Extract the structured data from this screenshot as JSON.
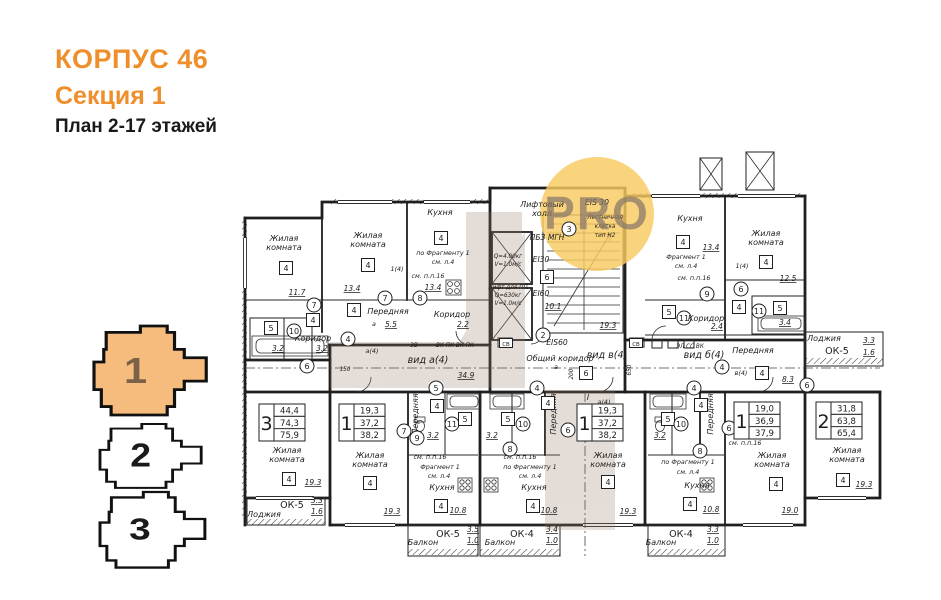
{
  "header": {
    "building": "КОРПУС 46",
    "section": "Секция 1",
    "plan": "План 2-17 этажей"
  },
  "colors": {
    "accent": "#EF8F2C",
    "section_fill": "#F6BC7D",
    "section_number_active": "#7a6148",
    "ink": "#1a1a1a",
    "watermark_yellow": "#F9CB5F",
    "watermark_text": "#8a7a6a",
    "watermark_tan": "#9a7b66"
  },
  "section_nav": {
    "items": [
      {
        "label": "1",
        "active": true
      },
      {
        "label": "2",
        "active": false
      },
      {
        "label": "3",
        "active": false
      }
    ]
  },
  "watermark": {
    "text": "PRO"
  },
  "apartment_stamps": [
    {
      "rooms": "3",
      "area_living": "44,4",
      "area_total": "74,3",
      "area_full": "75,9",
      "x": 259,
      "y": 404
    },
    {
      "rooms": "1",
      "area_living": "19,3",
      "area_total": "37,2",
      "area_full": "38,2",
      "x": 339,
      "y": 404
    },
    {
      "rooms": "1",
      "area_living": "19,3",
      "area_total": "37,2",
      "area_full": "38,2",
      "x": 577,
      "y": 404
    },
    {
      "rooms": "1",
      "area_living": "19,0",
      "area_total": "36,9",
      "area_full": "37,9",
      "x": 734,
      "y": 402
    },
    {
      "rooms": "2",
      "area_living": "31,8",
      "area_total": "63,8",
      "area_full": "65,4",
      "x": 816,
      "y": 402
    }
  ],
  "plan_labels": [
    {
      "t": "Жилая\nкомната",
      "x": 284,
      "y": 241,
      "k": "room"
    },
    {
      "t": "4",
      "x": 286,
      "y": 268,
      "k": "box"
    },
    {
      "t": "11.7",
      "x": 297,
      "y": 295,
      "k": "dim"
    },
    {
      "t": "7",
      "x": 314,
      "y": 305,
      "k": "circ"
    },
    {
      "t": "Жилая\nкомната",
      "x": 368,
      "y": 238,
      "k": "room"
    },
    {
      "t": "4",
      "x": 368,
      "y": 265,
      "k": "box"
    },
    {
      "t": "13.4",
      "x": 352,
      "y": 291,
      "k": "dim"
    },
    {
      "t": "7",
      "x": 385,
      "y": 298,
      "k": "circ"
    },
    {
      "t": "1(4)",
      "x": 397,
      "y": 271,
      "k": "small"
    },
    {
      "t": "Кухня",
      "x": 440,
      "y": 215,
      "k": "room"
    },
    {
      "t": "4",
      "x": 441,
      "y": 238,
      "k": "box"
    },
    {
      "t": "по Фрагменту 1",
      "x": 443,
      "y": 255,
      "k": "small"
    },
    {
      "t": "см. л.4",
      "x": 443,
      "y": 264,
      "k": "small"
    },
    {
      "t": "см. п.п.16",
      "x": 428,
      "y": 278,
      "k": "small"
    },
    {
      "t": "13.4",
      "x": 433,
      "y": 290,
      "k": "dim"
    },
    {
      "t": "8",
      "x": 420,
      "y": 298,
      "k": "circ"
    },
    {
      "t": "Передняя",
      "x": 388,
      "y": 314,
      "k": "room"
    },
    {
      "t": "4",
      "x": 354,
      "y": 310,
      "k": "box"
    },
    {
      "t": "а",
      "x": 374,
      "y": 326,
      "k": "small"
    },
    {
      "t": "5.5",
      "x": 391,
      "y": 327,
      "k": "dim"
    },
    {
      "t": "4",
      "x": 348,
      "y": 339,
      "k": "circ"
    },
    {
      "t": "а(4)",
      "x": 372,
      "y": 353,
      "k": "small"
    },
    {
      "t": "Коридор",
      "x": 452,
      "y": 317,
      "k": "room"
    },
    {
      "t": "2.2",
      "x": 463,
      "y": 327,
      "k": "dim"
    },
    {
      "t": "Коридор",
      "x": 313,
      "y": 341,
      "k": "room"
    },
    {
      "t": "3.2",
      "x": 322,
      "y": 351,
      "k": "dim"
    },
    {
      "t": "4",
      "x": 313,
      "y": 320,
      "k": "box"
    },
    {
      "t": "10",
      "x": 294,
      "y": 331,
      "k": "circ"
    },
    {
      "t": "5",
      "x": 271,
      "y": 328,
      "k": "box"
    },
    {
      "t": "3.2",
      "x": 278,
      "y": 351,
      "k": "dim"
    },
    {
      "t": "6",
      "x": 307,
      "y": 366,
      "k": "circ"
    },
    {
      "t": "150",
      "x": 345,
      "y": 371,
      "k": "tiny"
    },
    {
      "t": "Лифтовый\nхолл",
      "x": 542,
      "y": 207,
      "k": "room"
    },
    {
      "t": "3",
      "x": 569,
      "y": 229,
      "k": "circ"
    },
    {
      "t": "EIS 30",
      "x": 597,
      "y": 205,
      "k": "tech"
    },
    {
      "t": "Лестничная\nклетка\nтип Н2",
      "x": 605,
      "y": 219,
      "k": "tiny"
    },
    {
      "t": "ПБЗ МГН",
      "x": 547,
      "y": 240,
      "k": "tech"
    },
    {
      "t": "Q=4.00кг",
      "x": 508,
      "y": 258,
      "k": "tiny"
    },
    {
      "t": "V=1.0м/с",
      "x": 508,
      "y": 266,
      "k": "tiny"
    },
    {
      "t": "EI30",
      "x": 541,
      "y": 262,
      "k": "tech"
    },
    {
      "t": "6",
      "x": 547,
      "y": 277,
      "k": "box"
    },
    {
      "t": "Лифт для ПП",
      "x": 508,
      "y": 289,
      "k": "tiny"
    },
    {
      "t": "Q=630кг",
      "x": 508,
      "y": 297,
      "k": "tiny"
    },
    {
      "t": "V=1.0м/с",
      "x": 508,
      "y": 305,
      "k": "tiny"
    },
    {
      "t": "EI60",
      "x": 541,
      "y": 296,
      "k": "tech"
    },
    {
      "t": "10.1",
      "x": 553,
      "y": 309,
      "k": "dim"
    },
    {
      "t": "19.3",
      "x": 608,
      "y": 328,
      "k": "dim"
    },
    {
      "t": "2",
      "x": 543,
      "y": 335,
      "k": "circ"
    },
    {
      "t": "EIS60",
      "x": 557,
      "y": 345,
      "k": "tech"
    },
    {
      "t": "Общий коридор",
      "x": 560,
      "y": 361,
      "k": "room"
    },
    {
      "t": "вид а(4)",
      "x": 428,
      "y": 363,
      "k": "view"
    },
    {
      "t": "34.9",
      "x": 466,
      "y": 378,
      "k": "dim"
    },
    {
      "t": "вид в(4)",
      "x": 607,
      "y": 358,
      "k": "view"
    },
    {
      "t": "вид б(4)",
      "x": 704,
      "y": 358,
      "k": "view"
    },
    {
      "t": "6",
      "x": 586,
      "y": 373,
      "k": "box"
    },
    {
      "t": "а",
      "x": 556,
      "y": 369,
      "k": "small"
    },
    {
      "t": "650",
      "x": 631,
      "y": 370,
      "k": "tiny",
      "v": true
    },
    {
      "t": "200",
      "x": 573,
      "y": 374,
      "k": "tiny",
      "v": true
    },
    {
      "t": "3В",
      "x": 414,
      "y": 347,
      "k": "tiny"
    },
    {
      "t": "ВК ПК ВК ПК",
      "x": 455,
      "y": 347,
      "k": "tiny"
    },
    {
      "t": "СВ",
      "x": 506,
      "y": 343,
      "k": "sbox"
    },
    {
      "t": "СВ",
      "x": 636,
      "y": 343,
      "k": "sbox"
    },
    {
      "t": "ЭЛ СС ВК",
      "x": 690,
      "y": 348,
      "k": "tiny"
    },
    {
      "t": "Кухня",
      "x": 690,
      "y": 221,
      "k": "room"
    },
    {
      "t": "4",
      "x": 683,
      "y": 242,
      "k": "box"
    },
    {
      "t": "13.4",
      "x": 711,
      "y": 250,
      "k": "dim"
    },
    {
      "t": "Фрагмент 1",
      "x": 686,
      "y": 259,
      "k": "small"
    },
    {
      "t": "см. л.4",
      "x": 686,
      "y": 268,
      "k": "small"
    },
    {
      "t": "см. п.п.16",
      "x": 694,
      "y": 280,
      "k": "small"
    },
    {
      "t": "9",
      "x": 707,
      "y": 294,
      "k": "circ"
    },
    {
      "t": "5",
      "x": 669,
      "y": 312,
      "k": "box"
    },
    {
      "t": "11",
      "x": 684,
      "y": 318,
      "k": "circ"
    },
    {
      "t": "Коридор",
      "x": 706,
      "y": 321,
      "k": "room"
    },
    {
      "t": "2.4",
      "x": 717,
      "y": 329,
      "k": "dim"
    },
    {
      "t": "1(4)",
      "x": 742,
      "y": 268,
      "k": "small"
    },
    {
      "t": "6",
      "x": 741,
      "y": 289,
      "k": "circ"
    },
    {
      "t": "4",
      "x": 739,
      "y": 307,
      "k": "box"
    },
    {
      "t": "Жилая\nкомната",
      "x": 766,
      "y": 236,
      "k": "room"
    },
    {
      "t": "4",
      "x": 766,
      "y": 262,
      "k": "box"
    },
    {
      "t": "12.5",
      "x": 788,
      "y": 281,
      "k": "dim"
    },
    {
      "t": "11",
      "x": 759,
      "y": 311,
      "k": "circ"
    },
    {
      "t": "5",
      "x": 780,
      "y": 308,
      "k": "box"
    },
    {
      "t": "3.4",
      "x": 785,
      "y": 325,
      "k": "dim"
    },
    {
      "t": "Передняя",
      "x": 753,
      "y": 353,
      "k": "room"
    },
    {
      "t": "4",
      "x": 762,
      "y": 373,
      "k": "box"
    },
    {
      "t": "в(4)",
      "x": 741,
      "y": 375,
      "k": "small"
    },
    {
      "t": "4",
      "x": 722,
      "y": 367,
      "k": "circ"
    },
    {
      "t": "8.3",
      "x": 788,
      "y": 382,
      "k": "dim"
    },
    {
      "t": "6",
      "x": 807,
      "y": 385,
      "k": "circ"
    },
    {
      "t": "Лоджия",
      "x": 824,
      "y": 341,
      "k": "room"
    },
    {
      "t": "ОК-5",
      "x": 837,
      "y": 354,
      "k": "ok"
    },
    {
      "t": "3.3",
      "x": 869,
      "y": 343,
      "k": "dim"
    },
    {
      "t": "1.6",
      "x": 869,
      "y": 355,
      "k": "dim"
    },
    {
      "t": "Жилая\nкомната",
      "x": 287,
      "y": 453,
      "k": "room"
    },
    {
      "t": "4",
      "x": 289,
      "y": 479,
      "k": "box"
    },
    {
      "t": "19.3",
      "x": 313,
      "y": 485,
      "k": "dim"
    },
    {
      "t": "Лоджия",
      "x": 264,
      "y": 517,
      "k": "room"
    },
    {
      "t": "ОК-5",
      "x": 292,
      "y": 508,
      "k": "ok"
    },
    {
      "t": "3.3",
      "x": 317,
      "y": 503,
      "k": "dim"
    },
    {
      "t": "1.6",
      "x": 317,
      "y": 514,
      "k": "dim"
    },
    {
      "t": "5",
      "x": 436,
      "y": 388,
      "k": "circ"
    },
    {
      "t": "Жилая\nкомната",
      "x": 370,
      "y": 458,
      "k": "room"
    },
    {
      "t": "4",
      "x": 370,
      "y": 483,
      "k": "box"
    },
    {
      "t": "19.3",
      "x": 392,
      "y": 514,
      "k": "dim"
    },
    {
      "t": "Передняя",
      "x": 418,
      "y": 414,
      "k": "room",
      "v": true
    },
    {
      "t": "4",
      "x": 437,
      "y": 406,
      "k": "box"
    },
    {
      "t": "11",
      "x": 452,
      "y": 424,
      "k": "circ"
    },
    {
      "t": "5",
      "x": 465,
      "y": 419,
      "k": "box"
    },
    {
      "t": "7",
      "x": 404,
      "y": 431,
      "k": "circ"
    },
    {
      "t": "9",
      "x": 417,
      "y": 438,
      "k": "circ"
    },
    {
      "t": "3.2",
      "x": 433,
      "y": 438,
      "k": "dim"
    },
    {
      "t": "см. п.п.16",
      "x": 430,
      "y": 459,
      "k": "small"
    },
    {
      "t": "Фрагмент 1",
      "x": 440,
      "y": 469,
      "k": "small"
    },
    {
      "t": "см. л.4",
      "x": 439,
      "y": 478,
      "k": "small"
    },
    {
      "t": "Кухня",
      "x": 442,
      "y": 490,
      "k": "room"
    },
    {
      "t": "4",
      "x": 441,
      "y": 506,
      "k": "box"
    },
    {
      "t": "10.8",
      "x": 458,
      "y": 513,
      "k": "dim"
    },
    {
      "t": "ОК-5",
      "x": 448,
      "y": 537,
      "k": "ok"
    },
    {
      "t": "3.5",
      "x": 473,
      "y": 532,
      "k": "dim"
    },
    {
      "t": "1.0",
      "x": 473,
      "y": 543,
      "k": "dim"
    },
    {
      "t": "Балкон",
      "x": 423,
      "y": 545,
      "k": "room"
    },
    {
      "t": "4",
      "x": 537,
      "y": 388,
      "k": "circ"
    },
    {
      "t": "5",
      "x": 508,
      "y": 419,
      "k": "box"
    },
    {
      "t": "10",
      "x": 523,
      "y": 424,
      "k": "circ"
    },
    {
      "t": "3.2",
      "x": 492,
      "y": 438,
      "k": "dim"
    },
    {
      "t": "8",
      "x": 510,
      "y": 449,
      "k": "circ"
    },
    {
      "t": "см. п.п.16",
      "x": 520,
      "y": 459,
      "k": "small"
    },
    {
      "t": "по Фрагменту 1",
      "x": 530,
      "y": 469,
      "k": "small"
    },
    {
      "t": "см. л.4",
      "x": 530,
      "y": 478,
      "k": "small"
    },
    {
      "t": "Кухня",
      "x": 534,
      "y": 490,
      "k": "room"
    },
    {
      "t": "4",
      "x": 533,
      "y": 506,
      "k": "box"
    },
    {
      "t": "10.8",
      "x": 549,
      "y": 513,
      "k": "dim"
    },
    {
      "t": "ОК-4",
      "x": 522,
      "y": 537,
      "k": "ok"
    },
    {
      "t": "3.4",
      "x": 552,
      "y": 532,
      "k": "dim"
    },
    {
      "t": "1.0",
      "x": 552,
      "y": 543,
      "k": "dim"
    },
    {
      "t": "Балкон",
      "x": 500,
      "y": 545,
      "k": "room"
    },
    {
      "t": "Передняя",
      "x": 556,
      "y": 414,
      "k": "room",
      "v": true
    },
    {
      "t": "4",
      "x": 548,
      "y": 403,
      "k": "box"
    },
    {
      "t": "6",
      "x": 568,
      "y": 430,
      "k": "circ"
    },
    {
      "t": "I",
      "x": 588,
      "y": 400,
      "k": "tech"
    },
    {
      "t": "а(4)",
      "x": 604,
      "y": 404,
      "k": "small"
    },
    {
      "t": "Жилая\nкомната",
      "x": 608,
      "y": 458,
      "k": "room"
    },
    {
      "t": "4",
      "x": 608,
      "y": 482,
      "k": "box"
    },
    {
      "t": "19.3",
      "x": 628,
      "y": 514,
      "k": "dim"
    },
    {
      "t": "4",
      "x": 694,
      "y": 388,
      "k": "circ"
    },
    {
      "t": "5",
      "x": 668,
      "y": 419,
      "k": "box"
    },
    {
      "t": "10",
      "x": 681,
      "y": 424,
      "k": "circ"
    },
    {
      "t": "3.2",
      "x": 660,
      "y": 438,
      "k": "dim"
    },
    {
      "t": "Передняя",
      "x": 713,
      "y": 414,
      "k": "room",
      "v": true
    },
    {
      "t": "4",
      "x": 701,
      "y": 405,
      "k": "box"
    },
    {
      "t": "8",
      "x": 700,
      "y": 451,
      "k": "circ"
    },
    {
      "t": "по Фрагменту 1",
      "x": 688,
      "y": 464,
      "k": "small"
    },
    {
      "t": "см. л.4",
      "x": 688,
      "y": 474,
      "k": "small"
    },
    {
      "t": "Кухня",
      "x": 697,
      "y": 488,
      "k": "room"
    },
    {
      "t": "4",
      "x": 690,
      "y": 504,
      "k": "box"
    },
    {
      "t": "10.8",
      "x": 711,
      "y": 512,
      "k": "dim"
    },
    {
      "t": "ОК-4",
      "x": 681,
      "y": 537,
      "k": "ok"
    },
    {
      "t": "3.3",
      "x": 713,
      "y": 532,
      "k": "dim"
    },
    {
      "t": "1.0",
      "x": 713,
      "y": 543,
      "k": "dim"
    },
    {
      "t": "Балкон",
      "x": 661,
      "y": 545,
      "k": "room"
    },
    {
      "t": "6",
      "x": 729,
      "y": 428,
      "k": "circ"
    },
    {
      "t": "см. п.п.16",
      "x": 745,
      "y": 445,
      "k": "small"
    },
    {
      "t": "Жилая\nкомната",
      "x": 772,
      "y": 458,
      "k": "room"
    },
    {
      "t": "4",
      "x": 776,
      "y": 484,
      "k": "box"
    },
    {
      "t": "19.0",
      "x": 790,
      "y": 513,
      "k": "dim"
    },
    {
      "t": "Жилая\nкомната",
      "x": 847,
      "y": 453,
      "k": "room"
    },
    {
      "t": "4",
      "x": 843,
      "y": 480,
      "k": "box"
    },
    {
      "t": "19.3",
      "x": 864,
      "y": 487,
      "k": "dim"
    }
  ]
}
